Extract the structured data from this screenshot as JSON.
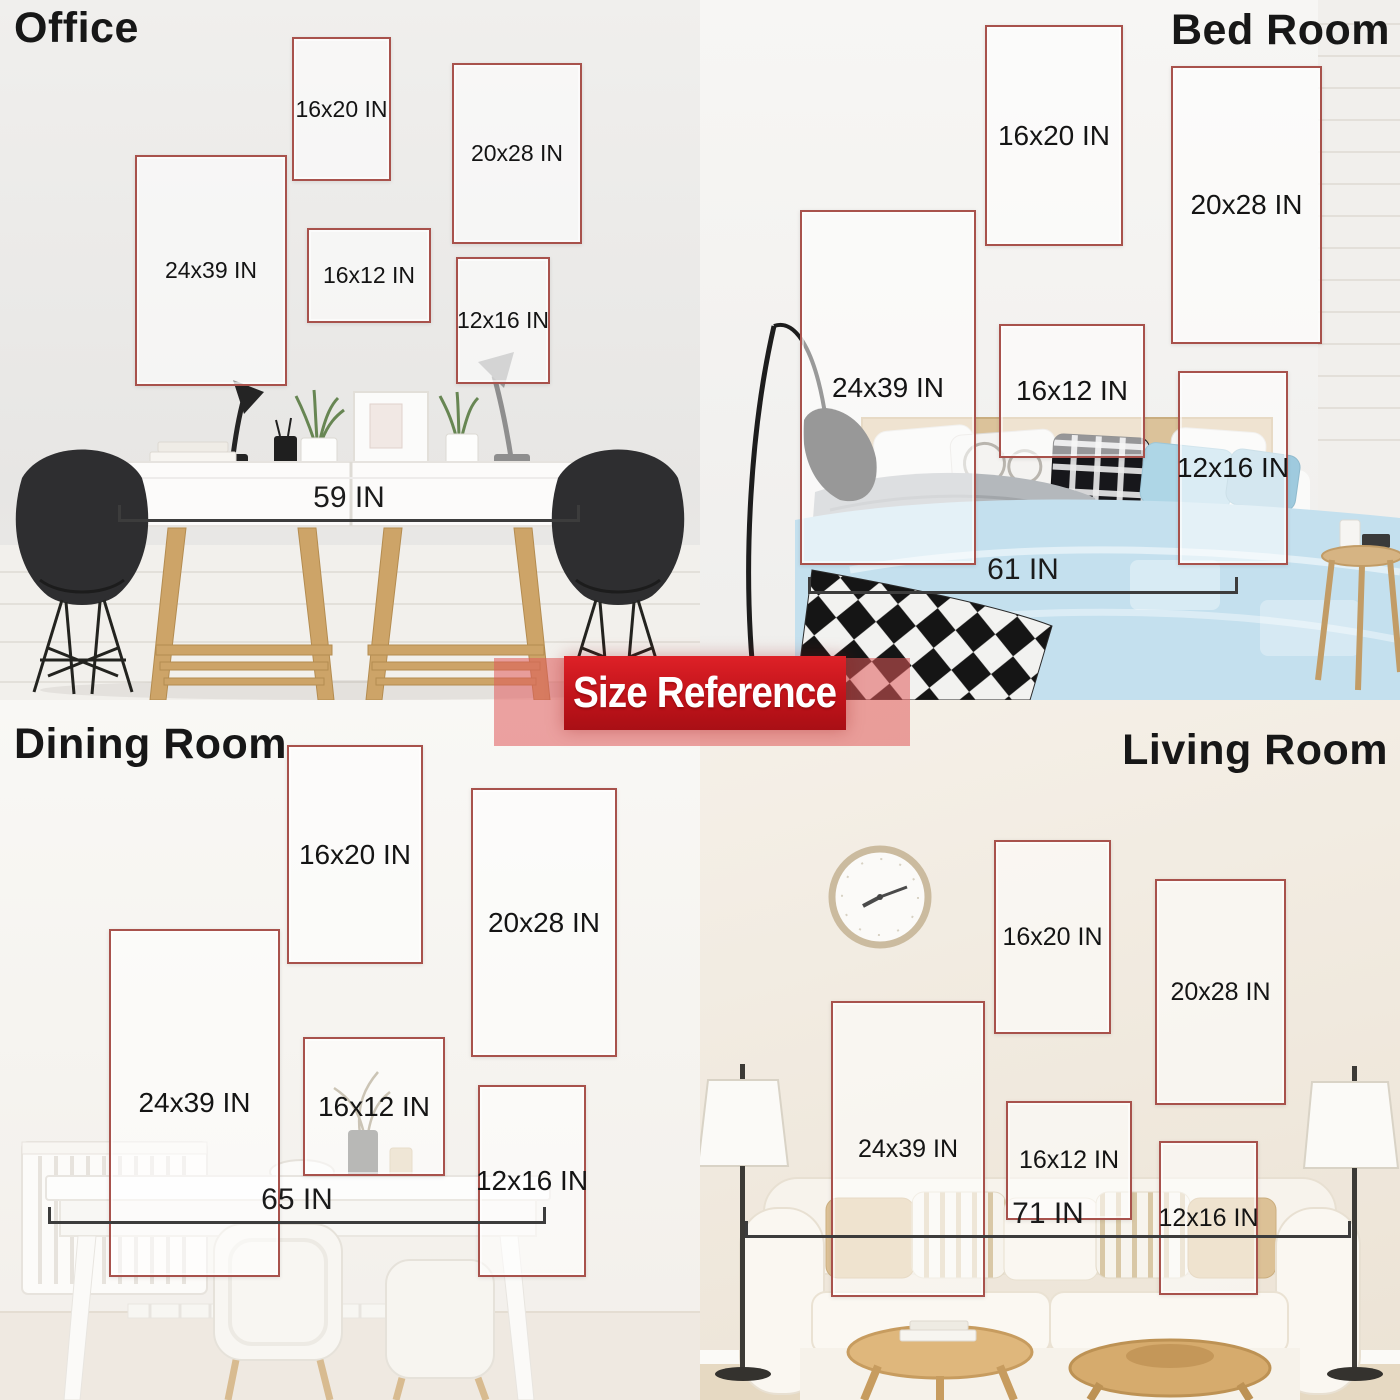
{
  "banner": {
    "label": "Size Reference"
  },
  "colors": {
    "frame_border": "#a8524c",
    "banner_red": "#c1131a",
    "banner_light_red": "#e05a5a",
    "measure_line": "#3c3c3c",
    "duvet_blue": "#c4e0ee"
  },
  "rooms": [
    {
      "name": "Office",
      "measurement": "59 IN",
      "frames": [
        {
          "label": "16x20 IN"
        },
        {
          "label": "20x28 IN"
        },
        {
          "label": "24x39 IN"
        },
        {
          "label": "16x12 IN"
        },
        {
          "label": "12x16 IN"
        }
      ]
    },
    {
      "name": "Bed Room",
      "measurement": "61 IN",
      "frames": [
        {
          "label": "16x20 IN"
        },
        {
          "label": "20x28 IN"
        },
        {
          "label": "24x39 IN"
        },
        {
          "label": "16x12 IN"
        },
        {
          "label": "12x16 IN"
        }
      ]
    },
    {
      "name": "Dining Room",
      "measurement": "65 IN",
      "frames": [
        {
          "label": "16x20 IN"
        },
        {
          "label": "20x28 IN"
        },
        {
          "label": "24x39 IN"
        },
        {
          "label": "16x12 IN"
        },
        {
          "label": "12x16 IN"
        }
      ]
    },
    {
      "name": "Living Room",
      "measurement": "71 IN",
      "frames": [
        {
          "label": "16x20 IN"
        },
        {
          "label": "20x28 IN"
        },
        {
          "label": "24x39 IN"
        },
        {
          "label": "16x12 IN"
        },
        {
          "label": "12x16 IN"
        }
      ]
    }
  ]
}
